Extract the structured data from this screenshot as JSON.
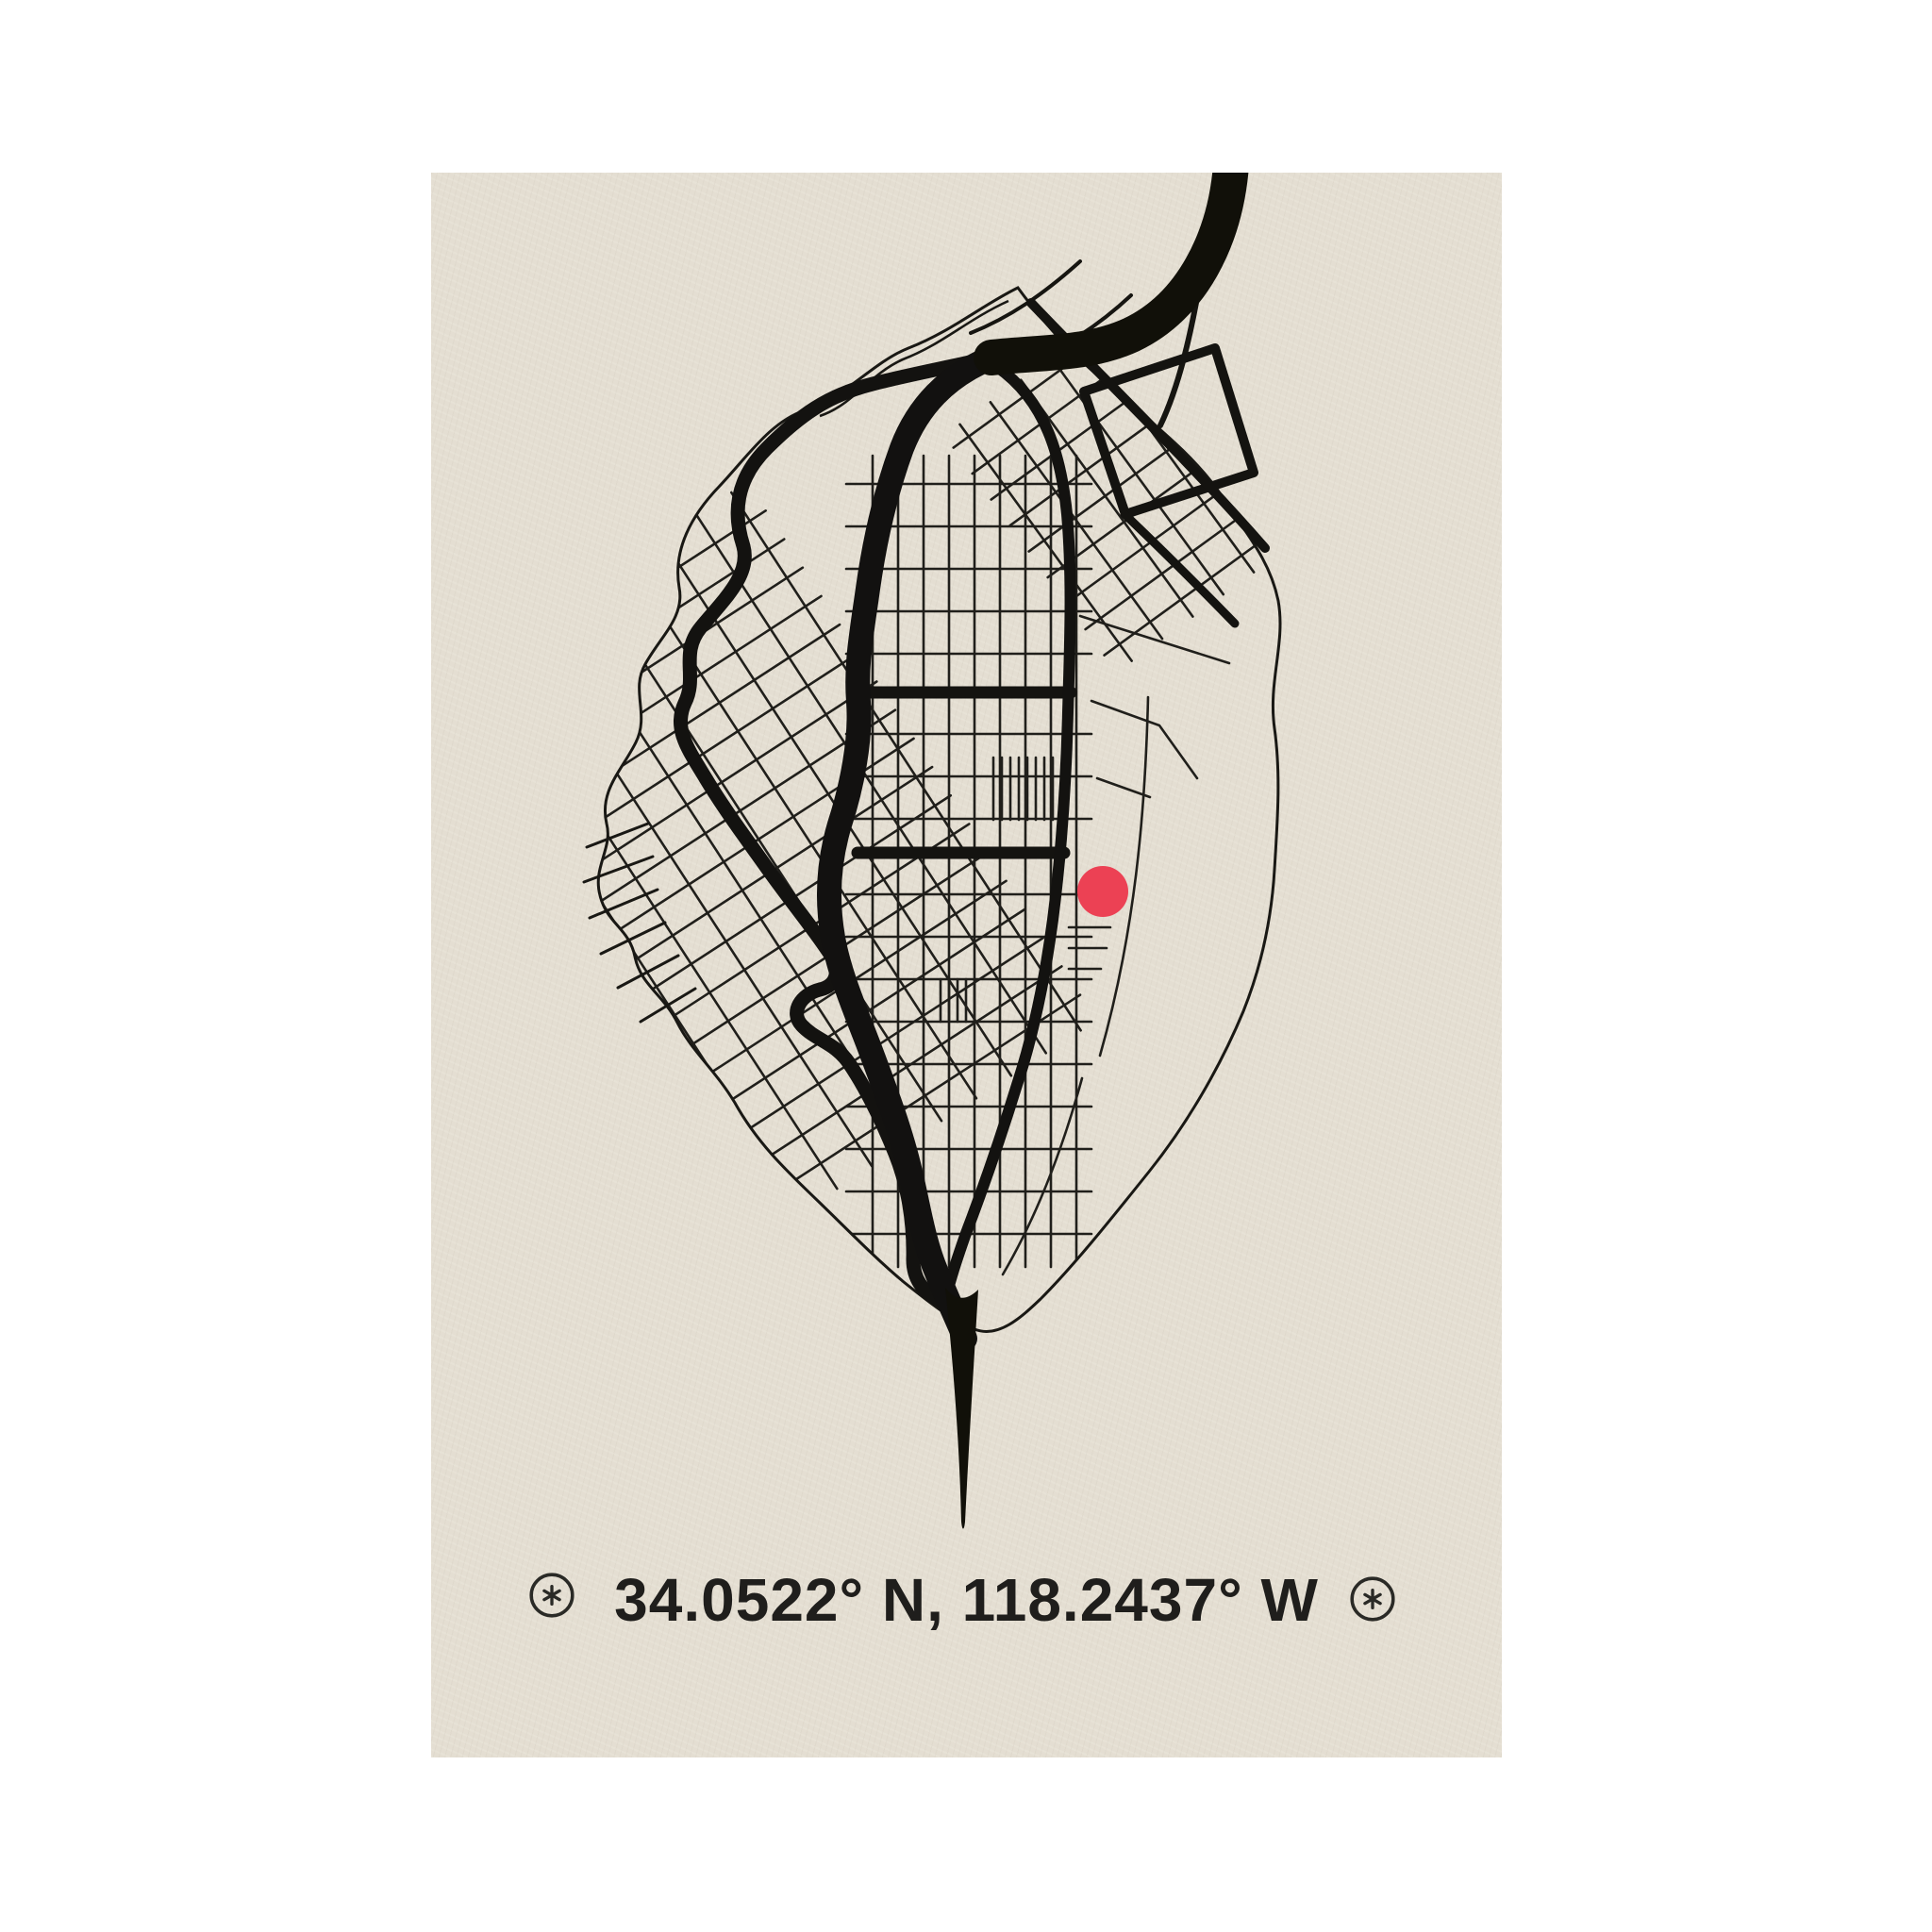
{
  "poster": {
    "coordinates_label": "34.0522° N, 118.2437° W",
    "marker": {
      "shape": "dot",
      "color": "#ec4154"
    },
    "colors": {
      "page_background": "#ffffff",
      "poster_background": "#e6e0d4",
      "map_line": "#1a1915",
      "caption_text": "#1f1e1c"
    },
    "icons": {
      "left": "compass-star-icon",
      "right": "compass-star-icon",
      "glyph": "✳"
    }
  }
}
